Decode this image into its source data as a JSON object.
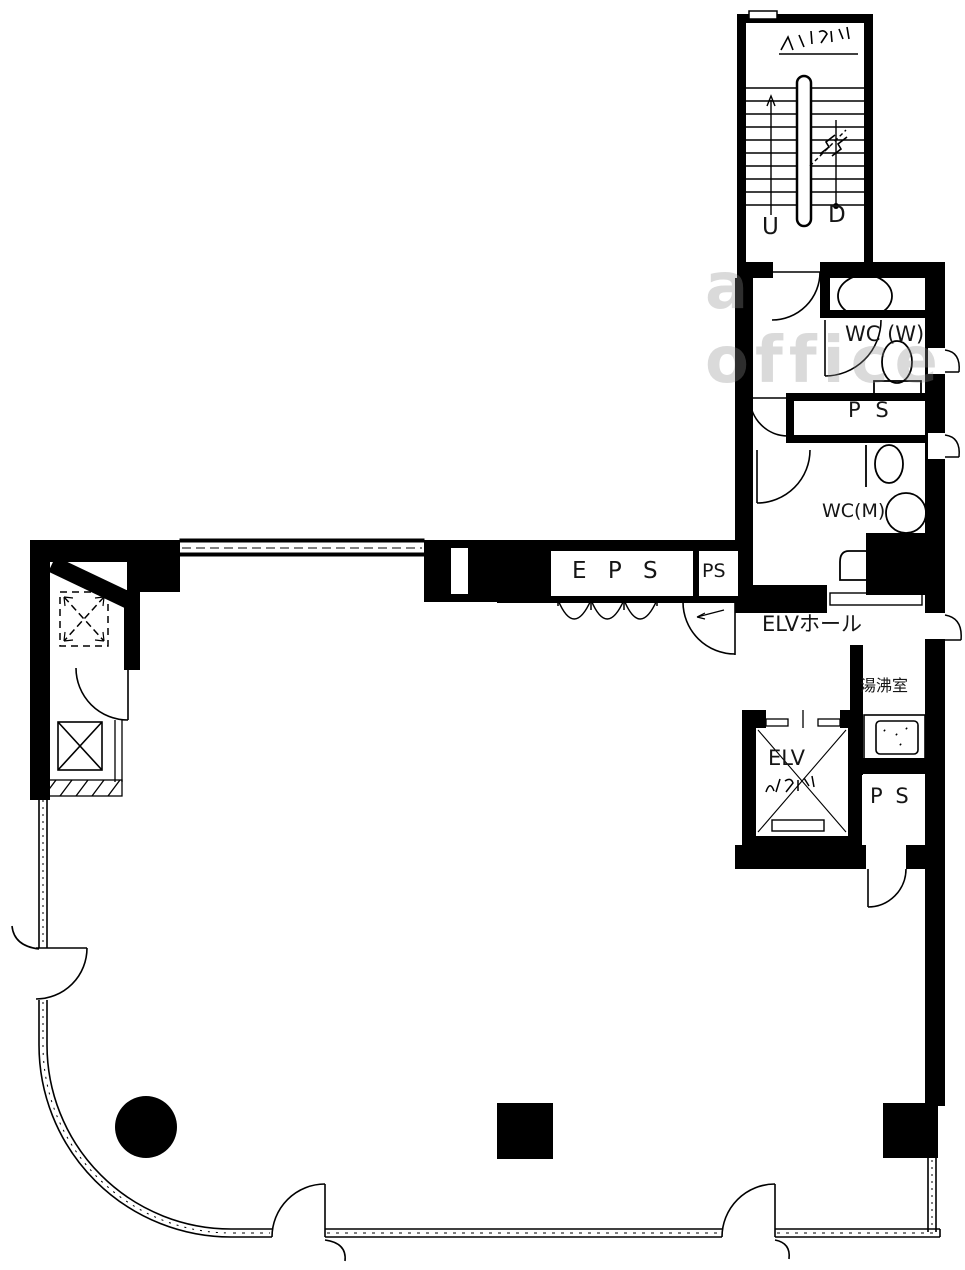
{
  "watermark": "a office",
  "labels": {
    "stair_up": "U",
    "stair_down": "D",
    "wc_w": "WC (W)",
    "ps_upper": "P S",
    "wc_m": "WC(M)",
    "eps": "E P S",
    "ps_small": "PS",
    "elv_hall": "ELVホール",
    "kitchenette": "湯沸室",
    "elv": "ELV",
    "ps_lower": "P S"
  }
}
